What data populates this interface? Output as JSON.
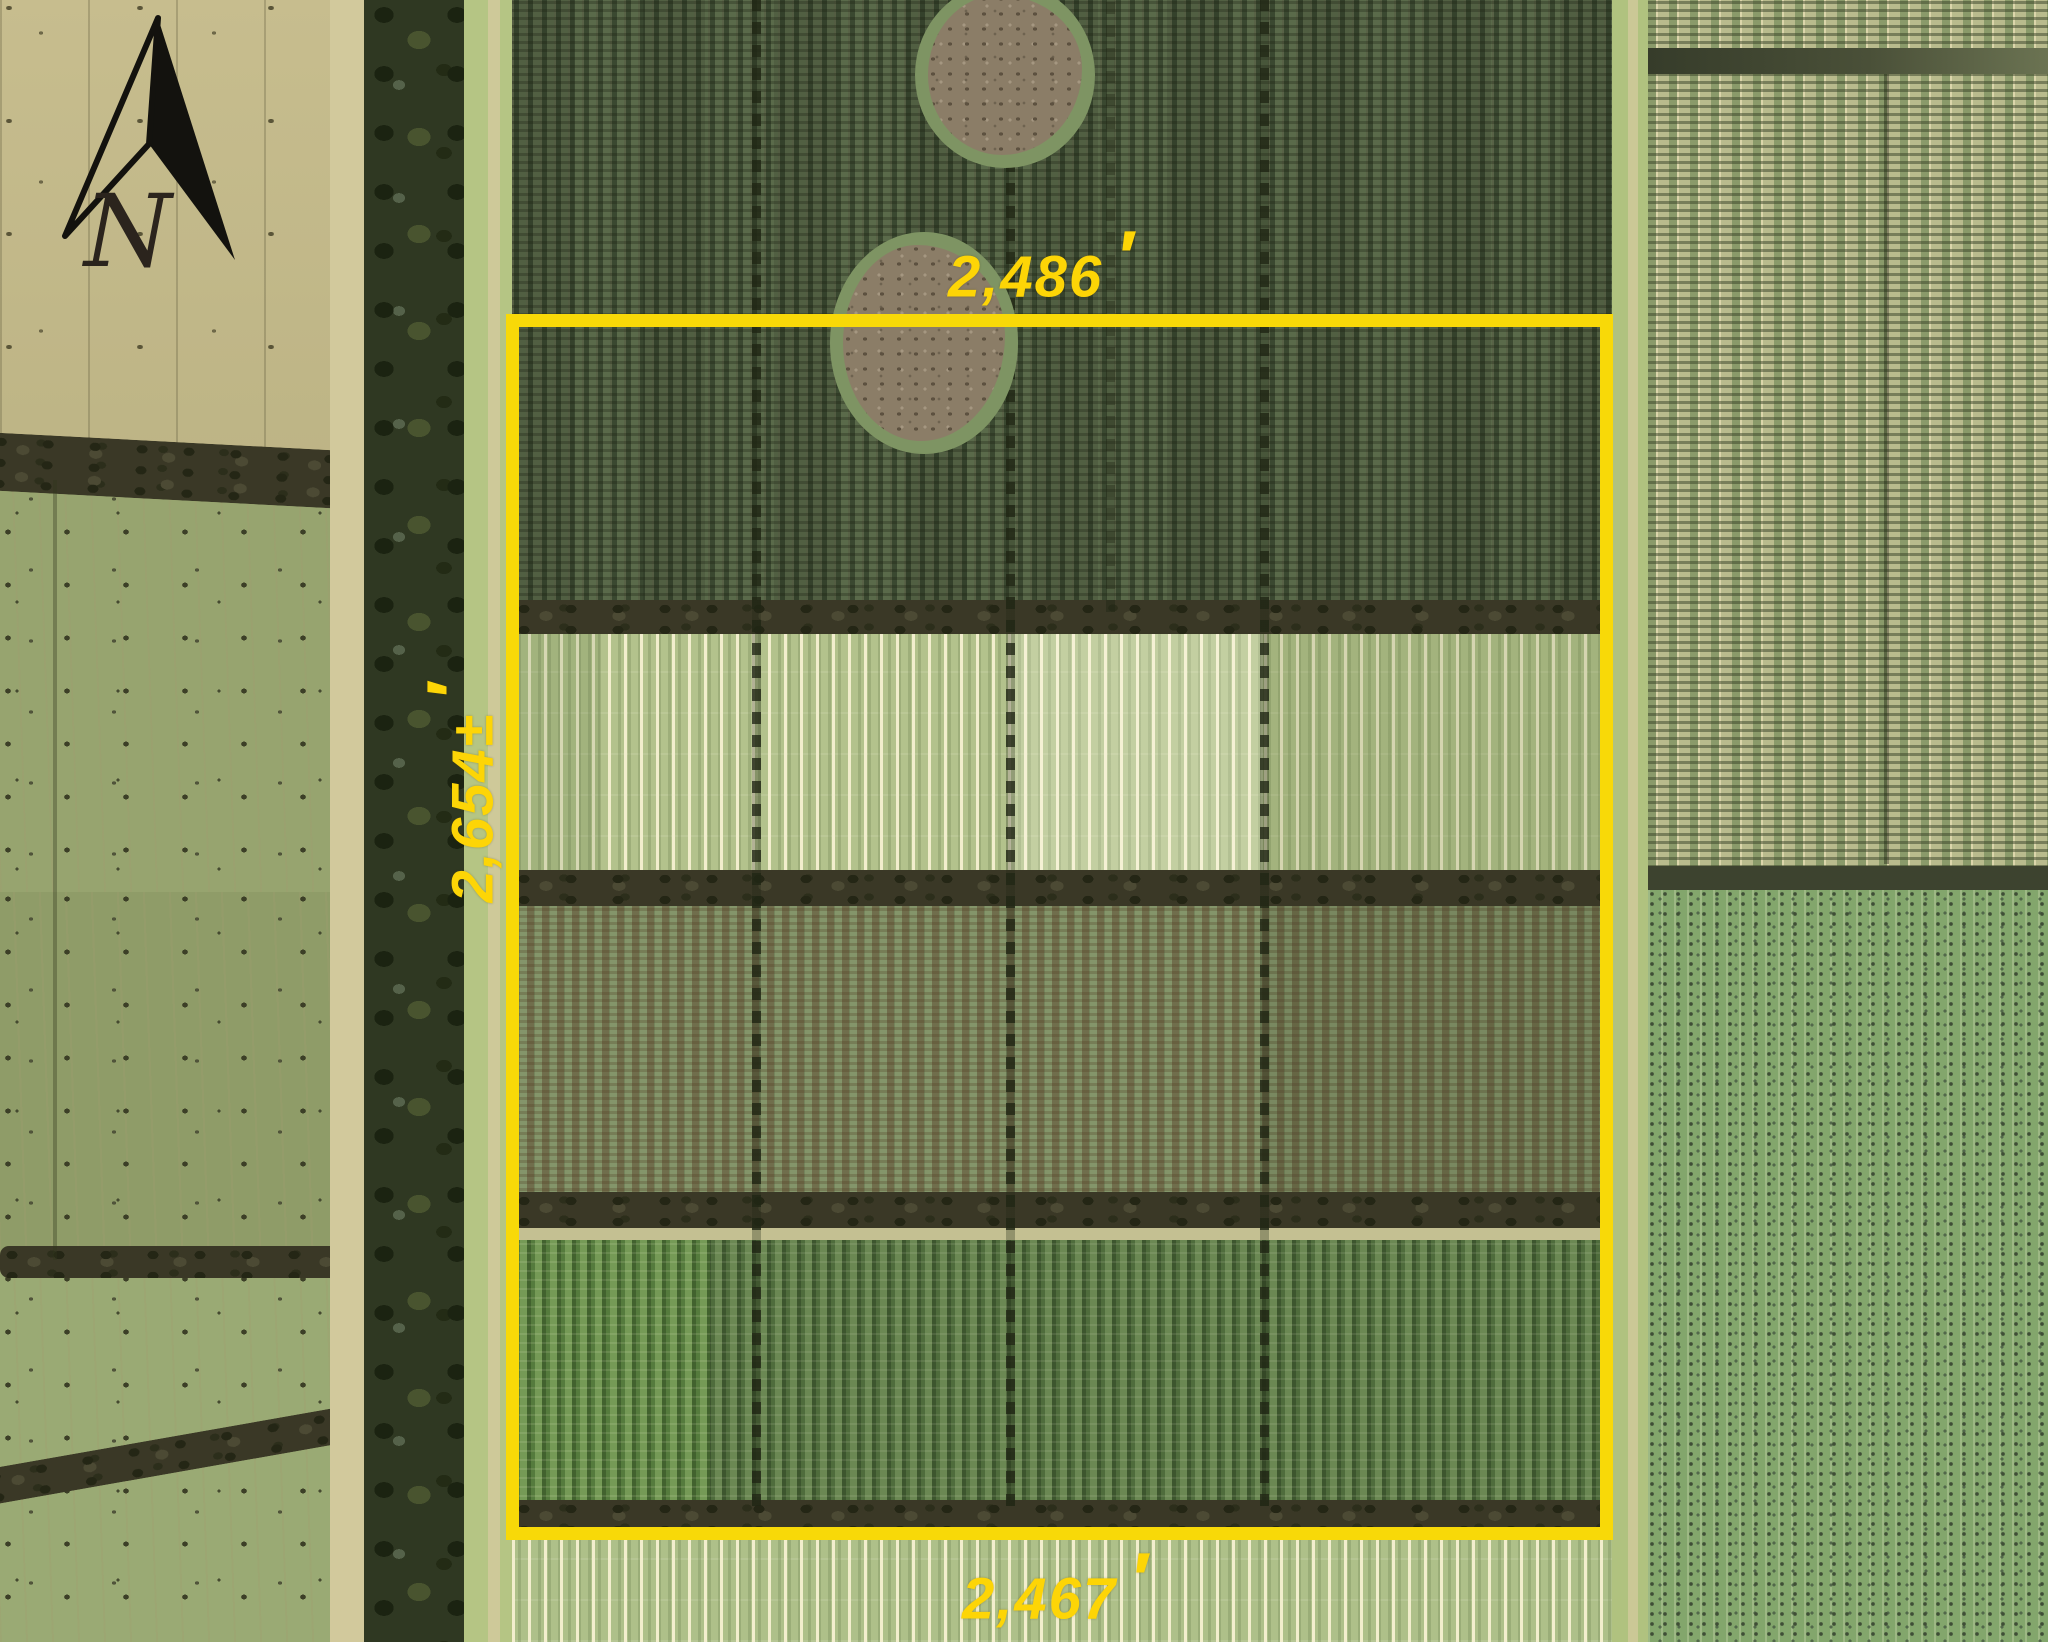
{
  "map": {
    "type": "aerial property survey",
    "labels_color": "#FDD506",
    "boundary": {
      "stroke_color": "#F8D908"
    },
    "north_arrow": {
      "label": "N"
    },
    "dimensions": {
      "top": {
        "value": "2,486",
        "unit": "′"
      },
      "west": {
        "value": "2,654±",
        "unit": "′"
      },
      "bottom": {
        "value": "2,467",
        "unit": "′"
      }
    },
    "terrain": {
      "regions": [
        "fallow tan field northwest",
        "olive scrub parcels west",
        "dense tree windbreak",
        "row-crop fields inside boundary",
        "pale lettuce strips band",
        "orchard rows east",
        "dotted orchard southeast"
      ]
    }
  }
}
